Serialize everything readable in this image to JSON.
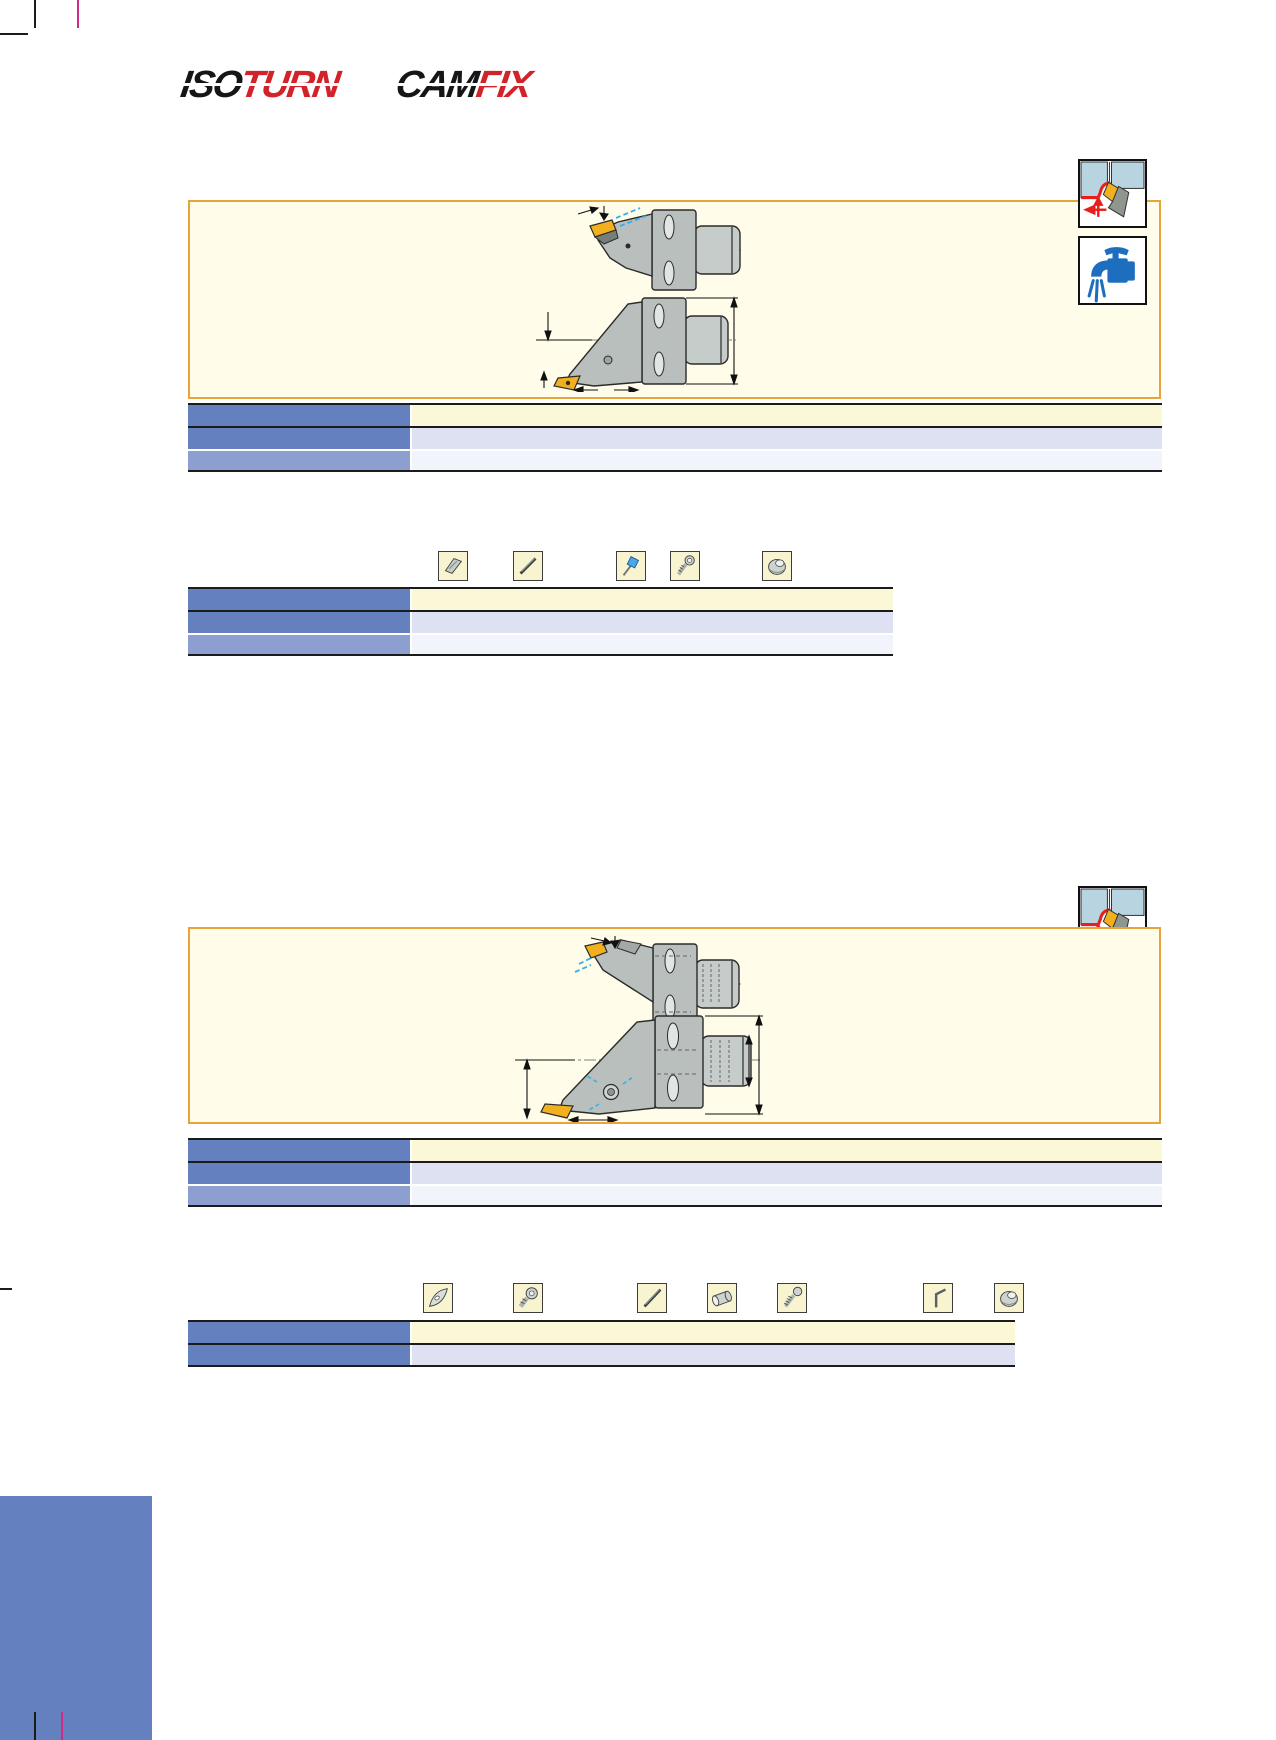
{
  "header": {
    "logos": [
      {
        "name": "isoturn",
        "black_part": "ISO",
        "red_part": "TURN"
      },
      {
        "name": "camfix",
        "black_part": "CAM",
        "red_part": "FIX"
      }
    ]
  },
  "palette": {
    "logo_red": "#d2232a",
    "logo_black": "#161616",
    "panel_bg": "#fffdea",
    "panel_border": "#e7a33c",
    "table_header_blue": "#6480be",
    "table_header_blue_light": "#8d9fd0",
    "row_cream": "#faf8d6",
    "row_lavender": "#dee1f2",
    "row_pale": "#f2f4fb",
    "icon_box_bg": "#f7f4cf",
    "coolant_blue": "#1e6ec0",
    "application_red": "#e8201d",
    "insert_yellow": "#f2b01e",
    "holder_gray": "#b9bfbc",
    "coolant_spray_cyan": "#35b0e5",
    "registration_magenta": "#cf2a86",
    "print_blue_block": "#6480be"
  },
  "sections": [
    {
      "corner_icons": [
        "external-turning-application-icon",
        "coolant-icon"
      ],
      "diagrams": [
        "holder-side-view",
        "holder-front-view"
      ],
      "main_table": {
        "header_col_cells": [
          "",
          "",
          ""
        ],
        "value_cells": [
          "",
          "",
          ""
        ]
      },
      "spare_parts_icons": [
        "shim-icon",
        "pin-icon",
        "torx-key-icon",
        "screw-icon",
        "clamp-icon"
      ],
      "spare_table": {
        "header_col_cells": [
          "",
          "",
          ""
        ],
        "value_cells": [
          "",
          "",
          ""
        ]
      }
    },
    {
      "corner_icons": [
        "external-turning-application-icon",
        "coolant-icon"
      ],
      "diagrams": [
        "holder-side-view",
        "holder-front-view"
      ],
      "main_table": {
        "header_col_cells": [
          "",
          "",
          ""
        ],
        "value_cells": [
          "",
          "",
          ""
        ]
      },
      "spare_parts_icons": [
        "insert-icon",
        "cartridge-screw-icon",
        "pin-icon",
        "sleeve-icon",
        "screw-icon",
        "hex-key-icon",
        "clamp-icon"
      ],
      "spare_table": {
        "header_col_cells": [
          "",
          ""
        ],
        "value_cells": [
          "",
          ""
        ]
      }
    }
  ]
}
